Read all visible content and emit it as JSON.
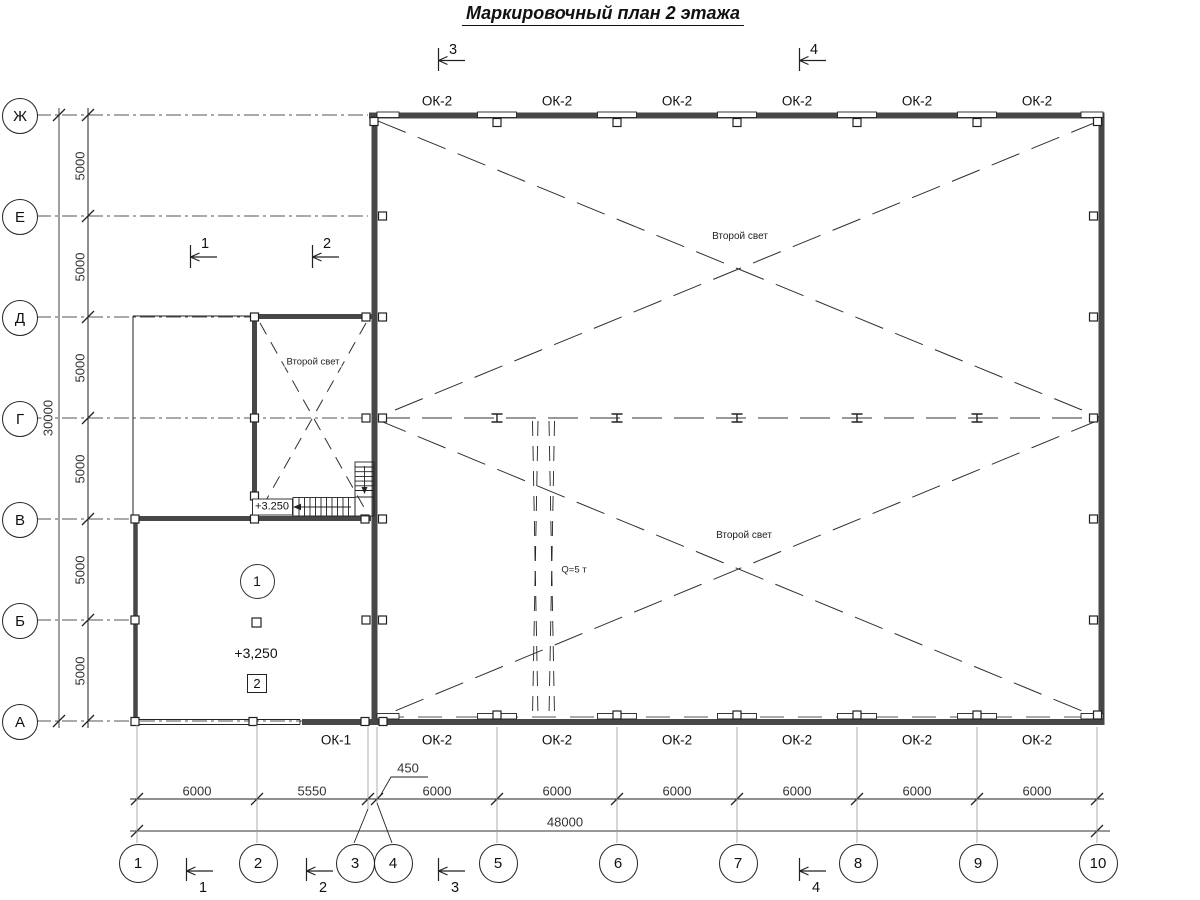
{
  "title": "Маркировочный план 2 этажа",
  "row_axes": [
    "Ж",
    "Е",
    "Д",
    "Г",
    "В",
    "Б",
    "А"
  ],
  "col_axes": [
    "1",
    "2",
    "3",
    "4",
    "5",
    "6",
    "7",
    "8",
    "9",
    "10"
  ],
  "v_dims": {
    "segments": [
      "5000",
      "5000",
      "5000",
      "5000",
      "5000",
      "5000"
    ],
    "total": "30000"
  },
  "h_dims": {
    "segments": [
      "6000",
      "5550",
      "450",
      "6000",
      "6000",
      "6000",
      "6000",
      "6000",
      "6000"
    ],
    "total": "48000"
  },
  "windows_top": [
    "ОК-2",
    "ОК-2",
    "ОК-2",
    "ОК-2",
    "ОК-2",
    "ОК-2"
  ],
  "windows_bottom": [
    "ОК-1",
    "ОК-2",
    "ОК-2",
    "ОК-2",
    "ОК-2",
    "ОК-2",
    "ОК-2"
  ],
  "sections": {
    "top": [
      "3",
      "4"
    ],
    "middle": [
      "1",
      "2"
    ],
    "bottom": [
      "1",
      "2",
      "3",
      "4"
    ]
  },
  "annotations": {
    "second_light": "Второй свет",
    "crane_capacity": "Q=5 т",
    "stair_level": "+3.250",
    "room_level": "+3,250",
    "room_number": "1",
    "room_tag": "2"
  },
  "colors": {
    "ink": "#222222",
    "wall_gray": "#474747",
    "dim_gray": "#999999",
    "background": "#ffffff"
  }
}
